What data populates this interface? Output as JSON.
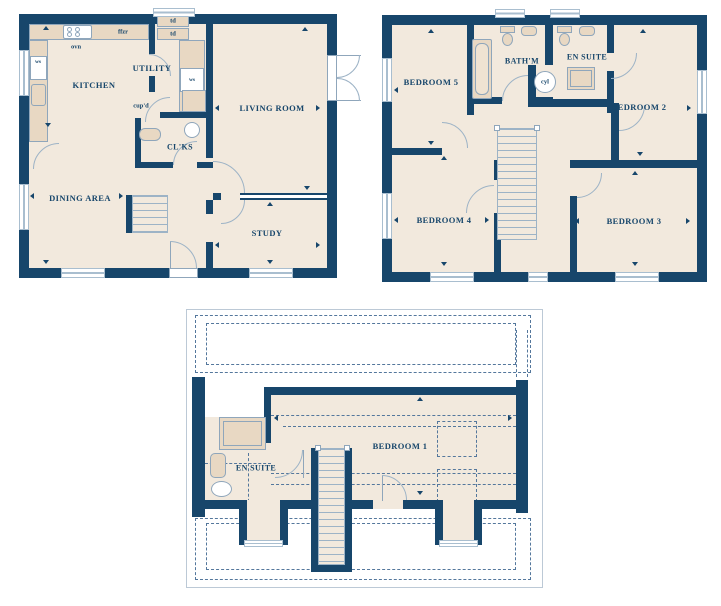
{
  "colors": {
    "wall": "#17466b",
    "floor": "#f2e9dd",
    "fixture": "#e8d8c3",
    "line": "#9db3c6",
    "dashed_roof_line": "#54779c",
    "roof_outline": "#bcc9d6",
    "label_text": "#17466b"
  },
  "ground_floor": {
    "rooms": {
      "kitchen": "KITCHEN",
      "utility": "UTILITY",
      "living_room": "LIVING ROOM",
      "dining_area": "DINING AREA",
      "cloakroom": "CL'KS",
      "study": "STUDY"
    },
    "fixtures": {
      "oven": "ovn",
      "fridge_freezer": "ffzr",
      "dryer_top": "td",
      "dryer_bottom": "td",
      "kitchen_sink": "ws",
      "utility_sink": "ws",
      "cupboard": "cup'd"
    }
  },
  "first_floor": {
    "rooms": {
      "bedroom_5": "BEDROOM 5",
      "bathroom": "BATH'M",
      "en_suite": "EN SUITE",
      "bedroom_2": "BEDROOM 2",
      "bedroom_4": "BEDROOM 4",
      "bedroom_3": "BEDROOM 3"
    },
    "fixtures": {
      "cylinder": "cyl"
    }
  },
  "second_floor": {
    "rooms": {
      "bedroom_1": "BEDROOM 1",
      "en_suite": "EN SUITE"
    }
  }
}
